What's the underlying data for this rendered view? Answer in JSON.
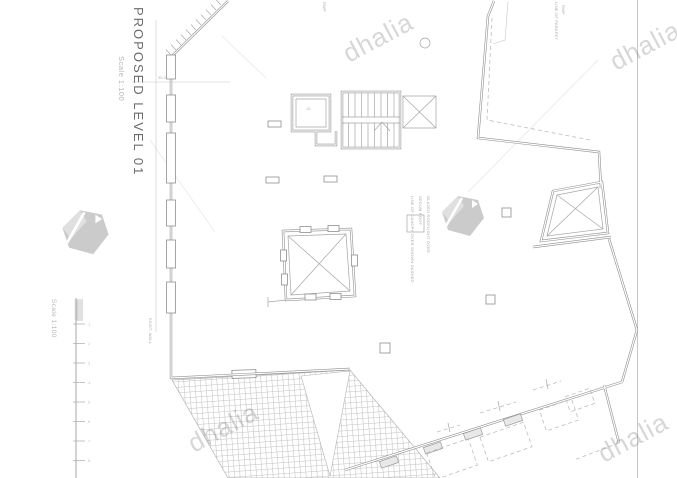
{
  "title_block": {
    "title": "PROPOSED LEVEL 01",
    "scale": "Scale 1:100"
  },
  "scale_bar": {
    "label": "Scale 1:100",
    "tick_labels": [
      "1",
      "2",
      "3",
      "4",
      "5",
      "6",
      "7",
      "8"
    ]
  },
  "watermark": {
    "text": "dhalia",
    "logo": "dhalia-gem",
    "color": "#9a9a9a"
  },
  "annotations": {
    "top_note": "RWP",
    "parapet_note_1": "LINE OF PARAPET",
    "parapet_note_2": "RWP",
    "rooflight_note_1": "LINE OF CANOPY OVER SHOWN DASHED",
    "rooflight_note_2": "SEDUM ROOF",
    "rooflight_note_3": "GLAZED ROOFLIGHT OVER",
    "wall_note": "EXIST. WALL",
    "lift_note": "16",
    "dim_note": "36.5"
  },
  "colors": {
    "wall": "#8f8f8f",
    "thin_line": "#a5a5a5",
    "hatch": "#bdbdbd",
    "watermark": "#9a9a9a"
  }
}
